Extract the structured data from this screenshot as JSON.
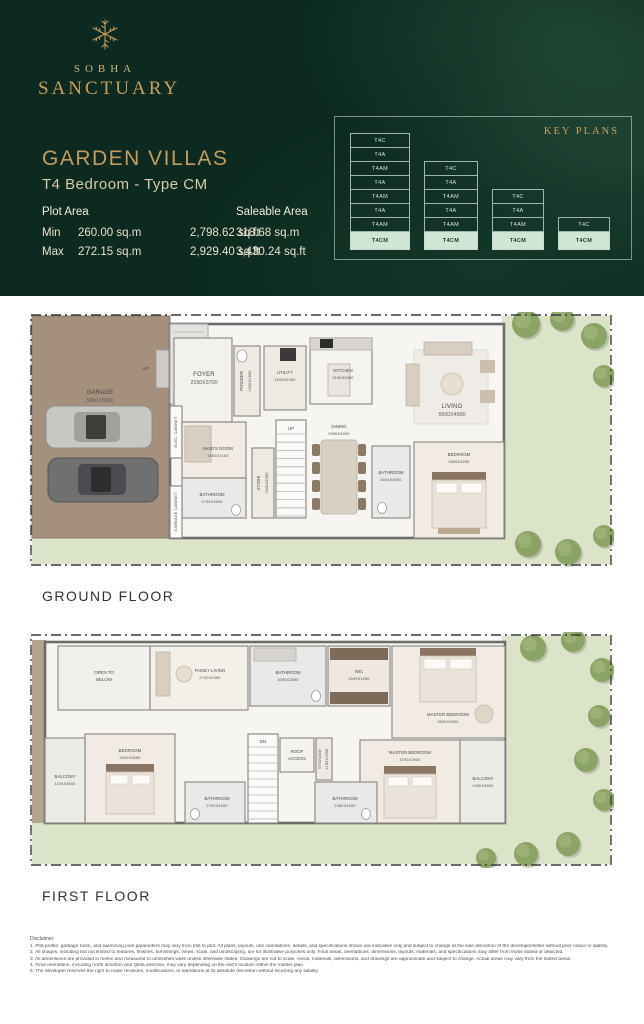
{
  "header": {
    "brand": {
      "name": "SOBHA",
      "subname": "SANCTUARY"
    },
    "title": "GARDEN VILLAS",
    "subtitle": "T4 Bedroom - Type CM",
    "plot_area": {
      "label": "Plot Area",
      "min_label": "Min",
      "min_sqm": "260.00 sq.m",
      "min_sqft": "2,798.62 sq.ft",
      "max_label": "Max",
      "max_sqm": "272.15 sq.m",
      "max_sqft": "2,929.40 sq.ft"
    },
    "saleable_area": {
      "label": "Saleable Area",
      "sqm": "318.68 sq.m",
      "sqft": "3,430.24 sq.ft"
    },
    "key_plans": {
      "label": "KEY PLANS",
      "highlight_color": "#cfe6d6",
      "highlighted_unit": "T4CM",
      "stacks": [
        {
          "units": [
            "T4C",
            "T4A",
            "T4AM",
            "T4A",
            "T4AM",
            "T4A",
            "T4AM",
            "T4CM"
          ]
        },
        {
          "units": [
            "T4C",
            "T4A",
            "T4AM",
            "T4A",
            "T4AM",
            "T4CM"
          ]
        },
        {
          "units": [
            "T4C",
            "T4A",
            "T4AM",
            "T4CM"
          ]
        },
        {
          "units": [
            "T4C",
            "T4CM"
          ]
        }
      ]
    }
  },
  "ground_floor": {
    "label": "GROUND FLOOR",
    "rooms": {
      "garage": {
        "name": "GARAGE",
        "dims": "5650X5500"
      },
      "elec_cabinet": {
        "name": "ELEC. CABINET"
      },
      "garbage_cabinet": {
        "name": "GARBAGE CABINET"
      },
      "entry_up": {
        "name": "UP"
      },
      "foyer": {
        "name": "FOYER",
        "dims": "2150X3700"
      },
      "powder": {
        "name": "POWDER",
        "dims": "1300X1800"
      },
      "utility": {
        "name": "UTILITY",
        "dims": "1200X2400"
      },
      "kitchen": {
        "name": "KITCHEN",
        "dims": "3100X2550"
      },
      "maids_room": {
        "name": "MAID'S ROOM",
        "dims": "2600X2100"
      },
      "bathroom_a": {
        "name": "BATHROOM",
        "dims": "2700X1600"
      },
      "store": {
        "name": "STORE",
        "dims": "1500X2050"
      },
      "stairs_up": {
        "name": "UP"
      },
      "dining": {
        "name": "DINING",
        "dims": "2950X4000"
      },
      "living": {
        "name": "LIVING",
        "dims": "5500X4500"
      },
      "bathroom_b": {
        "name": "BATHROOM",
        "dims": "1600X3000"
      },
      "bedroom": {
        "name": "BEDROOM",
        "dims": "3565X3250"
      }
    }
  },
  "first_floor": {
    "label": "FIRST FLOOR",
    "rooms": {
      "open_to_below": {
        "line1": "OPEN TO",
        "line2": "BELOW"
      },
      "family_living": {
        "name": "FAMILY LIVING",
        "dims": "2700X2950"
      },
      "bathroom_c": {
        "name": "BATHROOM",
        "dims": "3050X2550"
      },
      "wic": {
        "name": "WIC",
        "dims": "1500X1250"
      },
      "master_bedroom_a": {
        "name": "MASTER BEDROOM",
        "dims": "3500X3900"
      },
      "master_bedroom_b": {
        "name": "MASTER BEDROOM",
        "dims": "3700X3900"
      },
      "balcony_a": {
        "name": "BALCONY",
        "dims": "1100X3500"
      },
      "bedroom_b": {
        "name": "BEDROOM",
        "dims": "3200X3550"
      },
      "bathroom_d": {
        "name": "BATHROOM",
        "dims": "2700X1600"
      },
      "bathroom_e": {
        "name": "BATHROOM",
        "dims": "2350X1600"
      },
      "storage": {
        "name": "STORAGE",
        "dims": "1150X1950"
      },
      "roof_access": {
        "line1": "ROOF",
        "line2": "ACCESS"
      },
      "dn": {
        "name": "DN"
      },
      "balcony_b": {
        "name": "BALCONY",
        "dims": "1400X4650"
      }
    }
  },
  "disclaimer": {
    "title": "Disclaimer:",
    "lines": [
      "1. Plot profile, garbage room, and swimming pool parameters may vary from plot to plot. All plans, layouts, unit orientations, details, and specifications shown are indicative only and subject to change at the sole discretion of the developer/seller without prior notice or liability.",
      "2. All images, including but not limited to features, finishes, furnishings, views, scale, and landscaping, are for illustrative purposes only. Final areas, orientations, dimensions, layouts, materials, and specifications may differ from those stated or depicted.",
      "3. All dimensions are provided in metric and measured to unfinished walls unless otherwise stated. Drawings are not to scale. Areas, materials, dimensions, and drawings are approximate and subject to change. Actual areas may vary from the stated areas.",
      "4. Final orientation, including north direction and Qibla direction, may vary depending on the unit's location within the master plan.",
      "5. The developer reserves the right to make revisions, modifications, or alterations at its absolute discretion without incurring any liability."
    ]
  }
}
